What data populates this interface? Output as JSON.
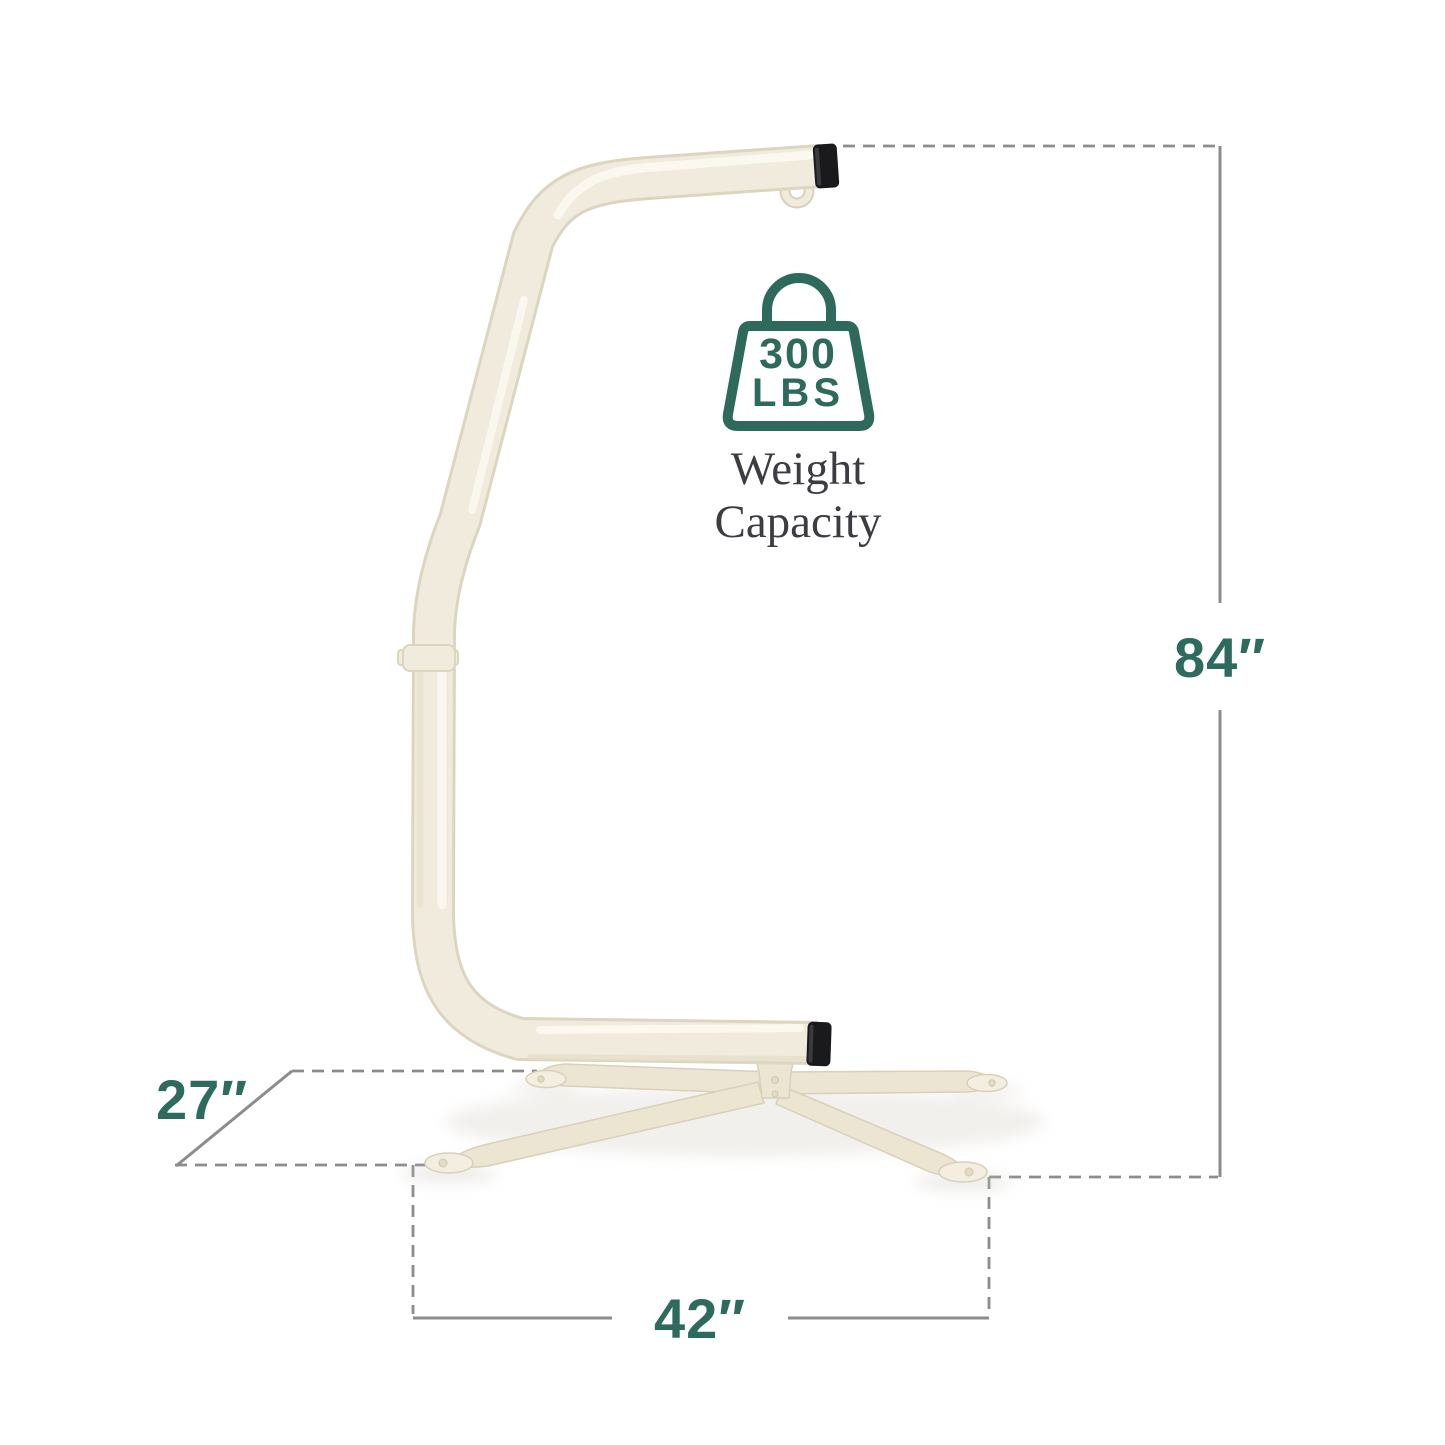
{
  "canvas": {
    "width": 1445,
    "height": 1445,
    "background": "#ffffff"
  },
  "colors": {
    "dimension_text": "#2e6b5e",
    "icon_green": "#2d6a5c",
    "caption_text": "#3c3c42",
    "line_gray": "#8c8c8c",
    "frame_cream": "#f0ebdc",
    "frame_outline": "#dcd5c0",
    "frame_highlight": "#fbf9f1",
    "frame_shade": "#e4ddc8",
    "base_cream": "#ebe5d2",
    "base_outline": "#d8d0b9",
    "base_pad": "#f3eee0",
    "cap_black": "#1a1a1c"
  },
  "capacity": {
    "amount": "300",
    "unit": "LBS",
    "caption_line1": "Weight",
    "caption_line2": "Capacity"
  },
  "dimensions": {
    "height": {
      "value": "84″"
    },
    "depth": {
      "value": "27″"
    },
    "width": {
      "value": "42″"
    }
  }
}
